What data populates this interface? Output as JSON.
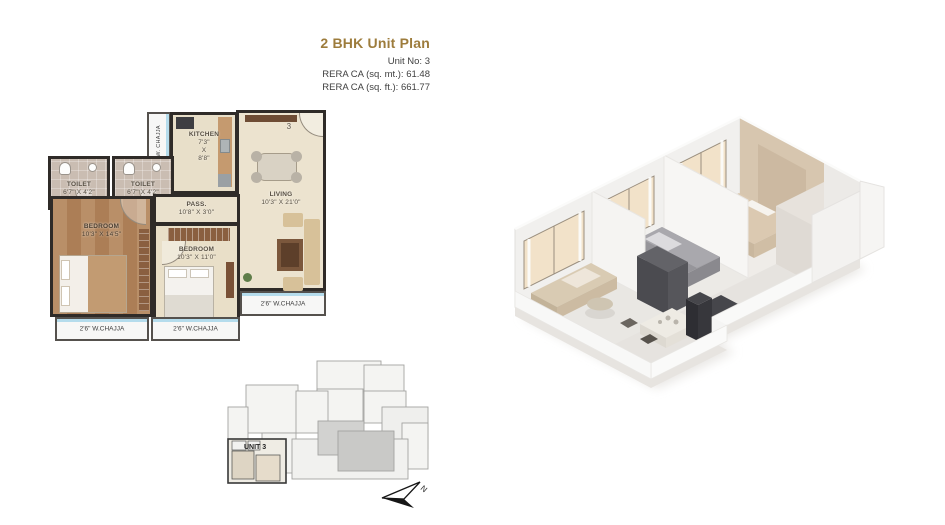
{
  "header": {
    "title": "2 BHK Unit Plan",
    "unit_no": "Unit No: 3",
    "rera_sq_mt": "RERA CA (sq. mt.): 61.48",
    "rera_sq_ft": "RERA CA (sq. ft.): 661.77",
    "accent_color": "#9d7c3c"
  },
  "plan2d": {
    "unit_number": "3",
    "rooms": {
      "living": {
        "name": "LIVING",
        "dims": "10'3\" X 21'0\""
      },
      "kitchen": {
        "name": "KITCHEN",
        "dims": [
          "7'3\"",
          "X",
          "8'8\""
        ]
      },
      "toilet1": {
        "name": "TOILET",
        "dims": "6'7\" X 4'2\""
      },
      "toilet2": {
        "name": "TOILET",
        "dims": "6'7\" X 4'2\""
      },
      "bedroom1": {
        "name": "BEDROOM",
        "dims": "10'3\" X 14'5\""
      },
      "bedroom2": {
        "name": "BEDROOM",
        "dims": "10'3\" X 11'0\""
      },
      "passage": {
        "name": "PASS.",
        "dims": "10'8\" X 3'0\""
      }
    },
    "chajja_top": "2'8\" W. CHAJJA",
    "chajja_bottom_left": "2'6\" W.CHAJJA",
    "chajja_bottom_mid": "2'6\" W.CHAJJA",
    "chajja_right": "2'6\" W.CHAJJA"
  },
  "key_plan": {
    "unit_label": "UNIT 3"
  },
  "compass": {
    "label": "N"
  }
}
